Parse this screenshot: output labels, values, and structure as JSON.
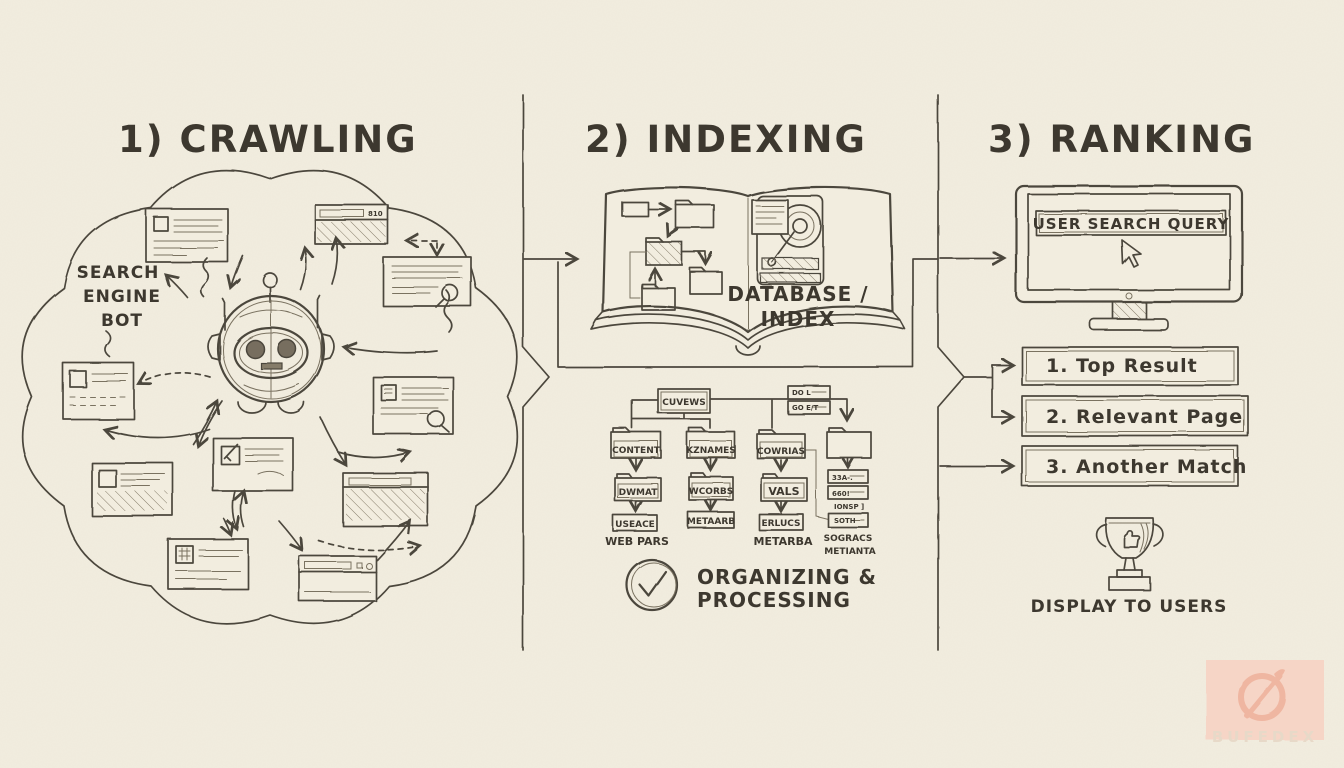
{
  "palette": {
    "paper": "#f2eddf",
    "ink": "#4c463c",
    "ink_soft": "#7a7261",
    "watermark_pink": "#f6d5c6"
  },
  "sections": {
    "crawling": {
      "title": "1) CRAWLING"
    },
    "indexing": {
      "title": "2) INDEXING"
    },
    "ranking": {
      "title": "3) RANKING"
    }
  },
  "crawling": {
    "bot_label": [
      "SEARCH",
      "ENGINE",
      "BOT"
    ],
    "browser_badge": "810"
  },
  "indexing": {
    "book_label": [
      "DATABASE /",
      "INDEX"
    ],
    "tree": {
      "root": "CUVEWS",
      "side_boxes": [
        "DO L",
        "GO E/T"
      ],
      "folders": [
        "CONTENT",
        "KZNAMES",
        "COWRIAS"
      ],
      "subfolders": [
        "DWMAT",
        "WCORBS",
        "VALS"
      ],
      "leaf_boxes": [
        "USEACE",
        "METAARB",
        "ERLUCS"
      ],
      "right_boxes": [
        "33A-.",
        "660!",
        "IONSP ]",
        "SOTH"
      ],
      "captions": [
        "WEB PARS",
        "METARBA",
        "SOGRACS",
        "METIANTA"
      ]
    },
    "status": [
      "ORGANIZING &",
      "PROCESSING"
    ]
  },
  "ranking": {
    "query": "USER SEARCH QUERY",
    "results": [
      "1. Top Result",
      "2. Relevant Page",
      "3. Another Match"
    ],
    "caption": "DISPLAY TO USERS"
  },
  "watermark": {
    "text": "BUFEDEX"
  }
}
